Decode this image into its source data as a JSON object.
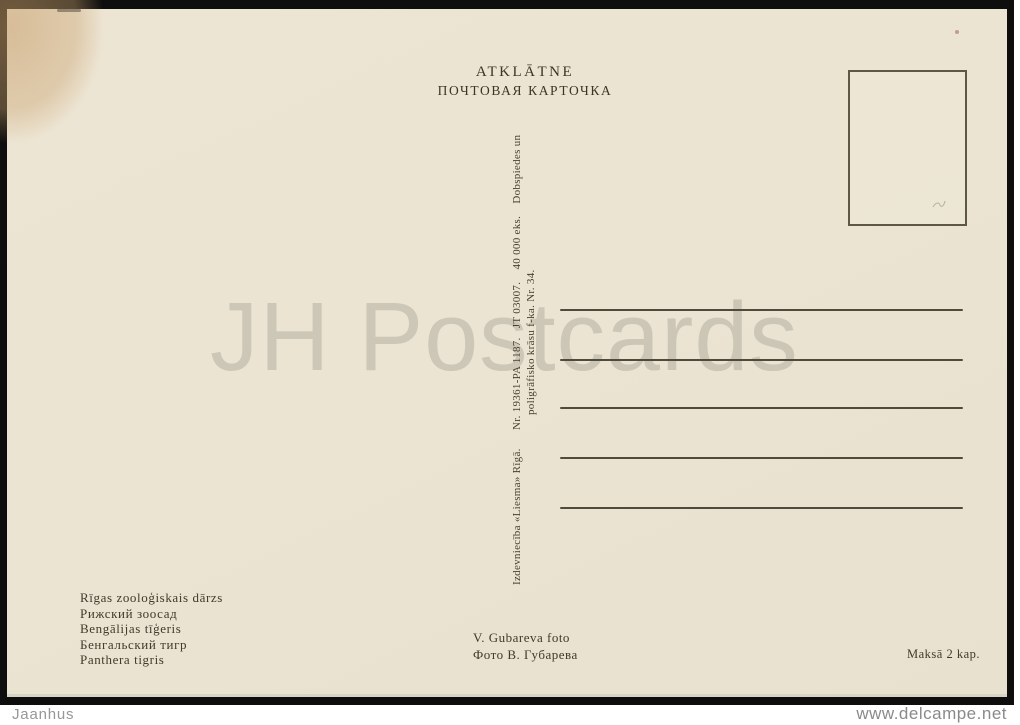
{
  "postcard": {
    "header": {
      "latvian": "ATKLĀTNE",
      "russian": "ПОЧТОВАЯ КАРТОЧКА"
    },
    "imprint": {
      "line1": "Izdevniecība «Liesma» Rīgā.      Nr. 19361-PA 1187.   JT 03007.    40 000 eks.    Dobspiedes un",
      "line2": "poligrāfisko krāsu f-ka. Nr. 34."
    },
    "address_line_count": 5,
    "caption_lines": [
      "Rīgas zooloģiskais dārzs",
      "Рижский зоосад",
      "Bengālijas tīģeris",
      "Бенгальский тигр",
      "Panthera tigris"
    ],
    "photo_credit": {
      "latin": "V. Gubareva foto",
      "cyrillic": "Фото В. Губарева"
    },
    "price": "Maksā 2 kap."
  },
  "scan": {
    "watermark": "JH Postcards",
    "footer_left": "Jaanhus",
    "footer_right": "www.delcampe.net"
  },
  "colors": {
    "paper": "#ece4d2",
    "ink": "#3d3829",
    "stain": "#c69c67",
    "frame_black": "#0e0e0e",
    "watermark_gray": "#85837b",
    "footer_text": "#979797"
  }
}
